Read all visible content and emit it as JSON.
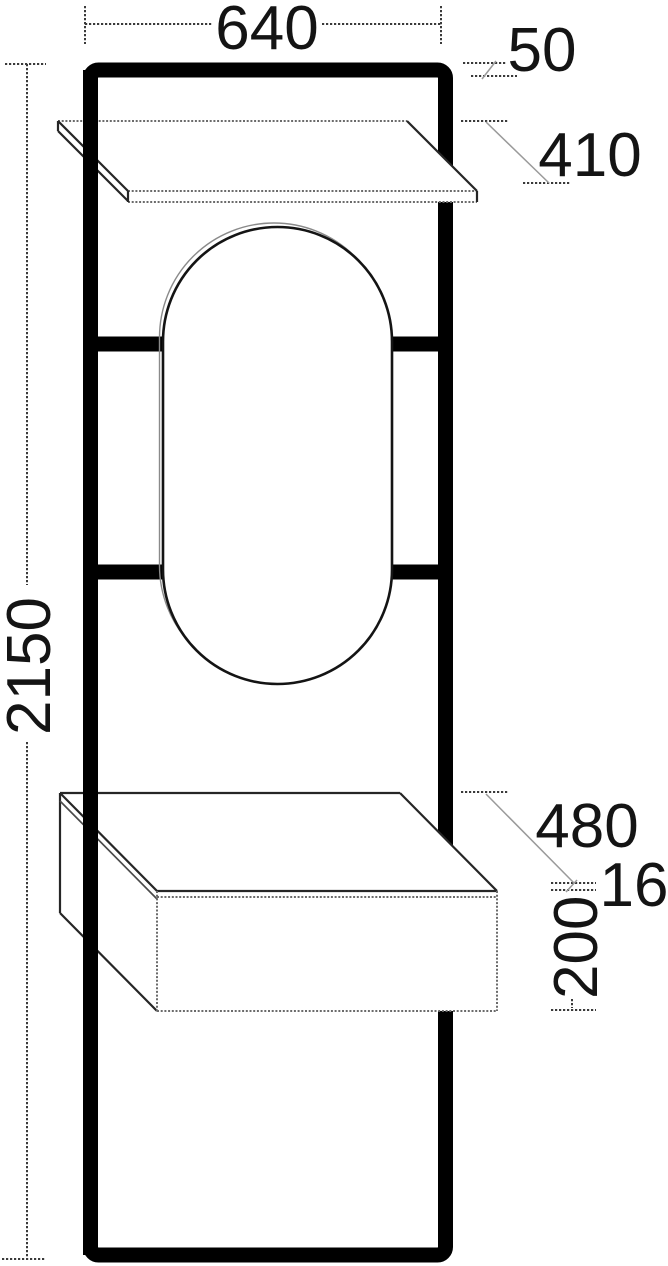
{
  "drawing": {
    "subject": "Dimensioned elevation drawing of a tall wall panel with shelf, oval mirror and drawer box",
    "unit": "mm",
    "colors": {
      "background": "#ffffff",
      "frame": "#000000",
      "dimension_lines": "#3a3a3a",
      "leader_lines": "#9a9a9a"
    }
  },
  "dimensions": {
    "overall_width_mm": "640",
    "frame_profile_mm": "50",
    "shelf_depth_mm": "410",
    "overall_height_mm": "2150",
    "drawer_depth_mm": "480",
    "drawer_top_thickness_mm": "16",
    "drawer_front_height_mm": "200"
  }
}
